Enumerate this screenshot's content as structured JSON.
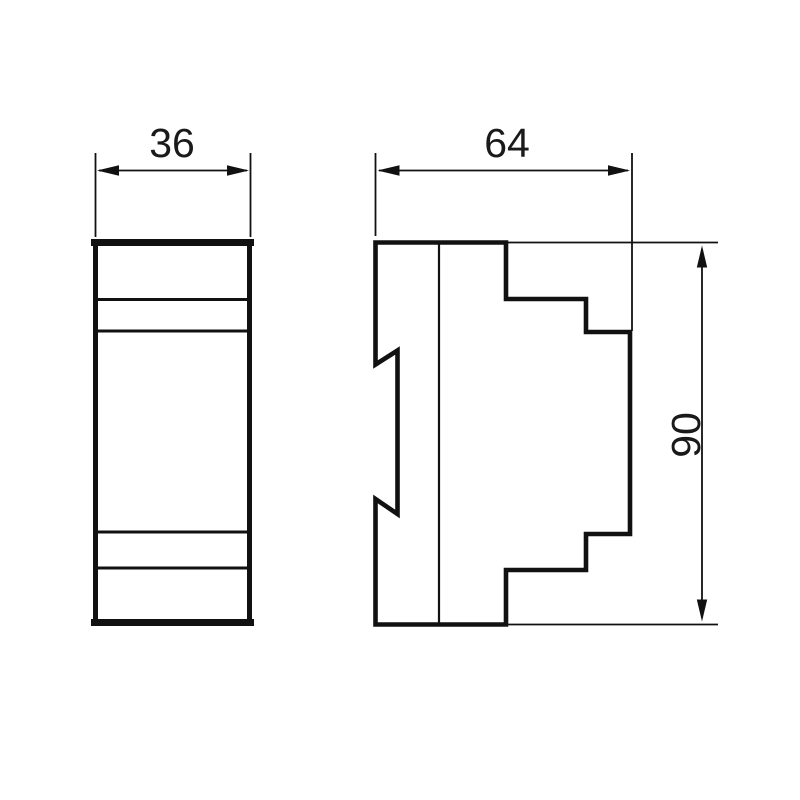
{
  "drawing": {
    "colors": {
      "background": "#ffffff",
      "line": "#111111",
      "text": "#1a1a1a"
    },
    "dimension_labels": {
      "front_width": "36",
      "side_depth": "64",
      "side_height": "90"
    }
  }
}
